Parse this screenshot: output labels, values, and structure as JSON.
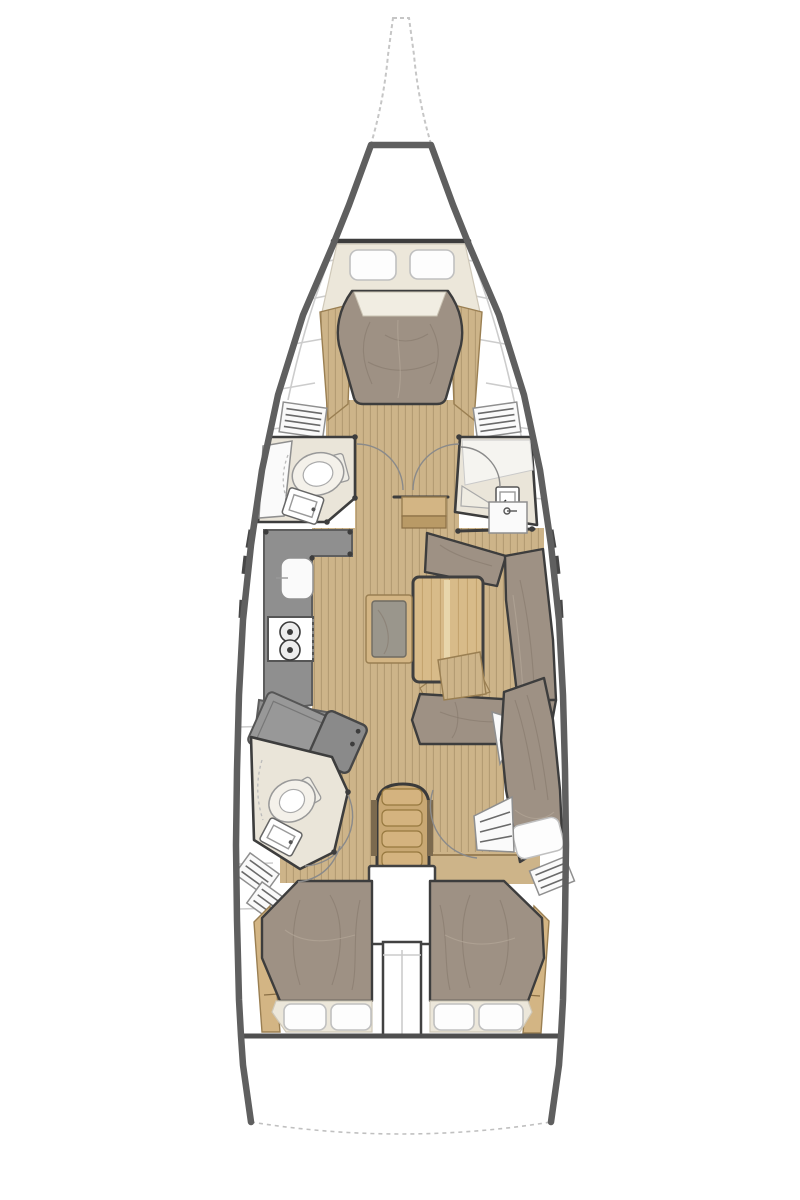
{
  "figure": {
    "kind": "Sailboat interior layout floor plan, top-down view, bow at top",
    "regions": "bow pulpit; foredeck locker; forward owner cabin with V-berth and two pillows; port forward head with toilet and sink; starboard forward shower room with sink; galley with sink and two-burner stove; salon with wood table, gray bench and U-shaped settee; nav station with angled chart table; aft port head with toilet and sink; companionway stairs; engine compartment; port aft double cabin; starboard aft cabin with double berth and hull-side berth; transom with swim platform"
  },
  "palette": {
    "paper": "#ffffff",
    "hull_line": "#5f5f5f",
    "wall_line": "#3d3d3d",
    "deck_seam": "#cccccc",
    "bow_dash": "#c6c6c6",
    "floor_wood": "#cdb489",
    "floor_plank": "#b29a72",
    "furniture_wood": "#d3b584",
    "furniture_wood_dark": "#b99a66",
    "stairs_wood": "#c9a873",
    "fabric": "#9e9184",
    "fabric_shadow": "#84776a",
    "fabric_light": "#b5a999",
    "mattress_cream": "#ece7da",
    "head_floor": "#eae5d9",
    "counter_gray": "#8f8f8f",
    "white_fixture": "#fafafa",
    "pillow_white": "#fdfdfd",
    "pillow_line": "#c0c0c0",
    "louver_line": "#6a6a6a"
  }
}
